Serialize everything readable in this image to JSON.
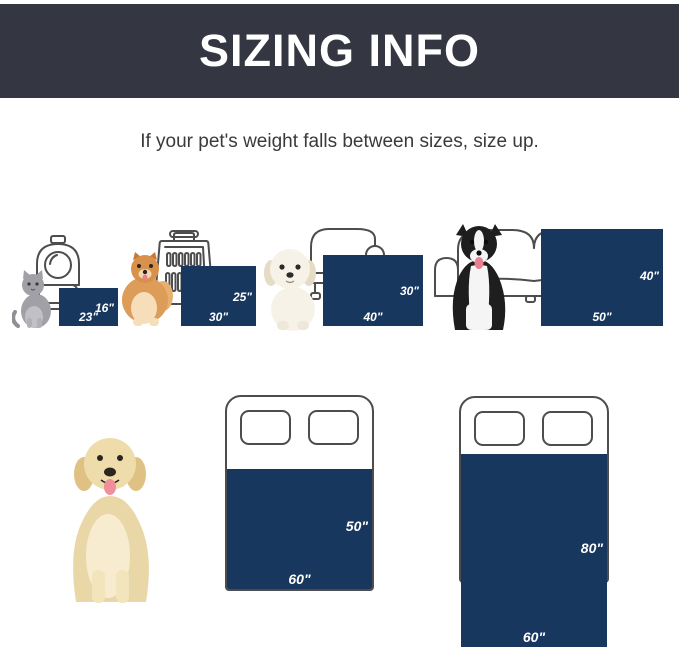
{
  "header": {
    "title": "SIZING INFO"
  },
  "subtitle": "If your pet's weight falls between sizes, size up.",
  "colors": {
    "banner_bg": "#343741",
    "blanket_navy": "#17375e",
    "outline_gray": "#4d4d4d",
    "label_text": "#ffffff",
    "subtitle_text": "#3a3a3a"
  },
  "blankets": [
    {
      "name": "23x16",
      "width": "23\"",
      "height": "16\"",
      "pet": "cat",
      "furniture": "pet-carrier"
    },
    {
      "name": "30x25",
      "width": "30\"",
      "height": "25\"",
      "pet": "pomeranian",
      "furniture": "dog-crate"
    },
    {
      "name": "40x30",
      "width": "40\"",
      "height": "30\"",
      "pet": "puppy",
      "furniture": "armchair"
    },
    {
      "name": "50x40",
      "width": "50\"",
      "height": "40\"",
      "pet": "border-collie",
      "furniture": "sofa"
    },
    {
      "name": "60x50",
      "width": "60\"",
      "height": "50\"",
      "pet": "golden-retriever",
      "furniture": "bed"
    },
    {
      "name": "60x80",
      "width": "60\"",
      "height": "80\"",
      "pet": "",
      "furniture": "bed"
    }
  ]
}
